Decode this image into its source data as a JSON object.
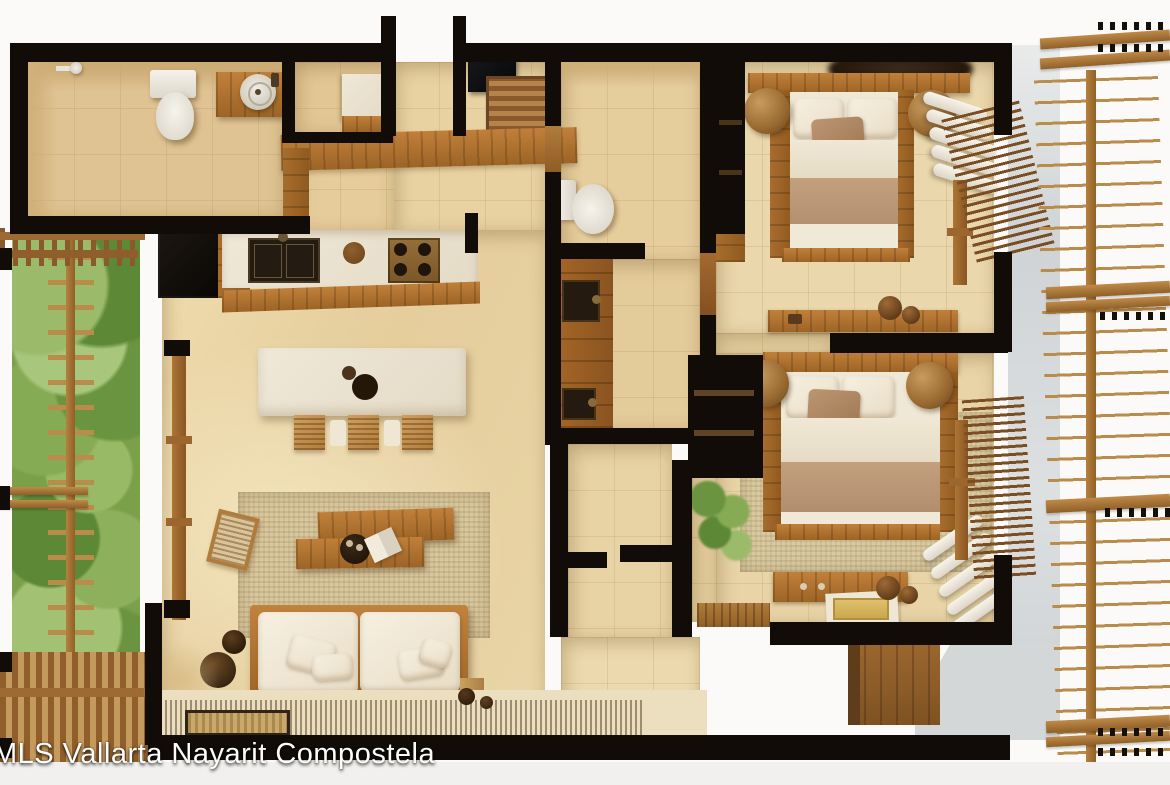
{
  "watermark": {
    "text": "MLS Vallarta Nayarit Compostela"
  },
  "palette": {
    "wall_black": "#110c08",
    "floor_beige": "#e8d4a6",
    "wood": "#a8702e",
    "wood_light": "#c89a58",
    "counter_cream": "#ece5d4",
    "linen_white": "#f3ebdb",
    "blanket_tan": "#bd9b79",
    "garden_green": "#7ca24e",
    "concrete_gray": "#d6d9da",
    "background": "#fbfaf9"
  },
  "plan": {
    "type": "apartment-floor-plan-3d-render",
    "rooms": [
      {
        "name": "bathroom-1",
        "position": "top-left"
      },
      {
        "name": "entry-closet",
        "position": "top-center-left"
      },
      {
        "name": "entry",
        "position": "top-center"
      },
      {
        "name": "wardrobe-nook",
        "position": "top-center"
      },
      {
        "name": "bathroom-2",
        "position": "center"
      },
      {
        "name": "vanity-laundry",
        "position": "center"
      },
      {
        "name": "kitchen",
        "position": "center-left"
      },
      {
        "name": "living-room",
        "position": "left"
      },
      {
        "name": "hallway",
        "position": "center-bottom"
      },
      {
        "name": "bedroom-1",
        "position": "top-right"
      },
      {
        "name": "bedroom-2",
        "position": "bottom-right"
      },
      {
        "name": "vertical-garden",
        "position": "far-left"
      },
      {
        "name": "balcony-trellis",
        "position": "far-right"
      },
      {
        "name": "terrace-deck",
        "position": "bottom"
      }
    ],
    "furniture": [
      "shower-head",
      "toilet",
      "round-vessel-sink",
      "wicker-dresser",
      "tv-panel",
      "refrigerator",
      "double-kitchen-sink",
      "gas-stove",
      "kitchen-island",
      "bar-stools",
      "coffee-table-planks",
      "rattan-armchair",
      "sofa",
      "area-rug",
      "clay-vases",
      "toilet-2",
      "vanity-sinks",
      "double-bed-1",
      "double-bed-2",
      "round-poufs",
      "towel-rolls",
      "writing-desk",
      "storage-bench",
      "hanging-plant",
      "louver-shutters",
      "wardrobe",
      "garden-ladder-trellis",
      "pergola-slats",
      "doormat"
    ]
  }
}
